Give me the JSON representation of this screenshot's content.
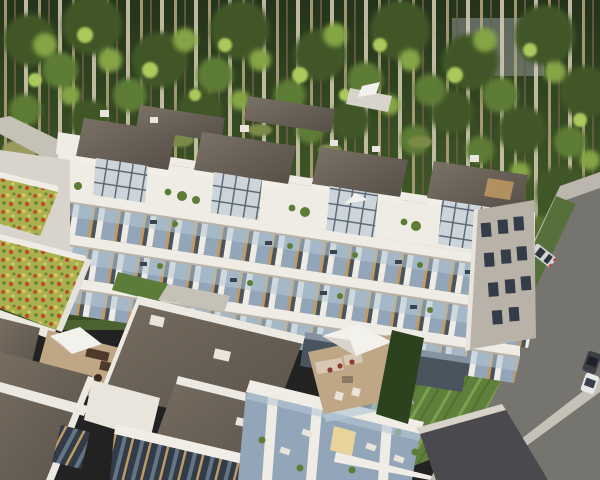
{
  "scene": {
    "type": "architectural-aerial-render",
    "title": "Aerial 3D rendering of a modern white apartment complex at a forest edge",
    "objects": [
      "dense forest backdrop with thin tree trunks",
      "long terraced apartment building with stacked balconies",
      "rooftop penthouses with dark flat roofs and glazed atriums",
      "roof terraces with plants and white parasols",
      "green sedum roofs on low wings",
      "foreground villas with dark flat roofs and glass facades",
      "wooden deck terraces with lounge furniture",
      "sloping lawn",
      "access road and parking with cars"
    ],
    "umbrella_count": 4,
    "car_count": 3
  },
  "palette": {
    "forest_dark": "#243219",
    "forest_mid": "#3d5526",
    "foliage_dark": "#3f5626",
    "foliage_mid": "#5d7c35",
    "foliage_light": "#84a444",
    "foliage_sun": "#abc95c",
    "trunk_light": "#b5a67f",
    "trunk_dark": "#6b5d47",
    "trunk_pale": "#d8cfb6",
    "undergrowth_olive": "#9a9a60",
    "undergrowth_tan": "#bdb47e",
    "path_gray": "#c6c1b7",
    "wall_white": "#efece5",
    "wall_shade": "#d9d4cb",
    "wall_gray": "#b8b2a8",
    "roof_dark": "#5f574d",
    "roof_mid": "#736a60",
    "glass_blue": "#93a5b8",
    "glass_light": "#ccd5da",
    "glass_dark": "#49545e",
    "railing_blue": "#b5c8d6",
    "wood_tan": "#c09a62",
    "accent_yellow": "#e8d49b",
    "deck_tan": "#bfa785",
    "umbrella_white": "#f3f1ec",
    "umbrella_shade": "#d9d5cd",
    "sofa_beige": "#d6c8b2",
    "cushion_red": "#8c3a34",
    "furniture_brown": "#4e3a2a",
    "sedum_base": "#a8b14d",
    "sedum_red": "#c04a30",
    "sedum_yellow": "#d8cc62",
    "sedum_green": "#6d8c38",
    "lawn_green": "#5f7f3c",
    "lawn_light": "#7da04e",
    "hedge_dark": "#2c421f",
    "asphalt": "#76746f",
    "asphalt_dark": "#4a4a4e",
    "concrete": "#bcb7ae",
    "car_silver": "#d4d5d6",
    "car_white": "#e9e9ea",
    "car_dark": "#3c3f45",
    "taillight_red": "#c03326",
    "window_dark": "#333c48"
  }
}
